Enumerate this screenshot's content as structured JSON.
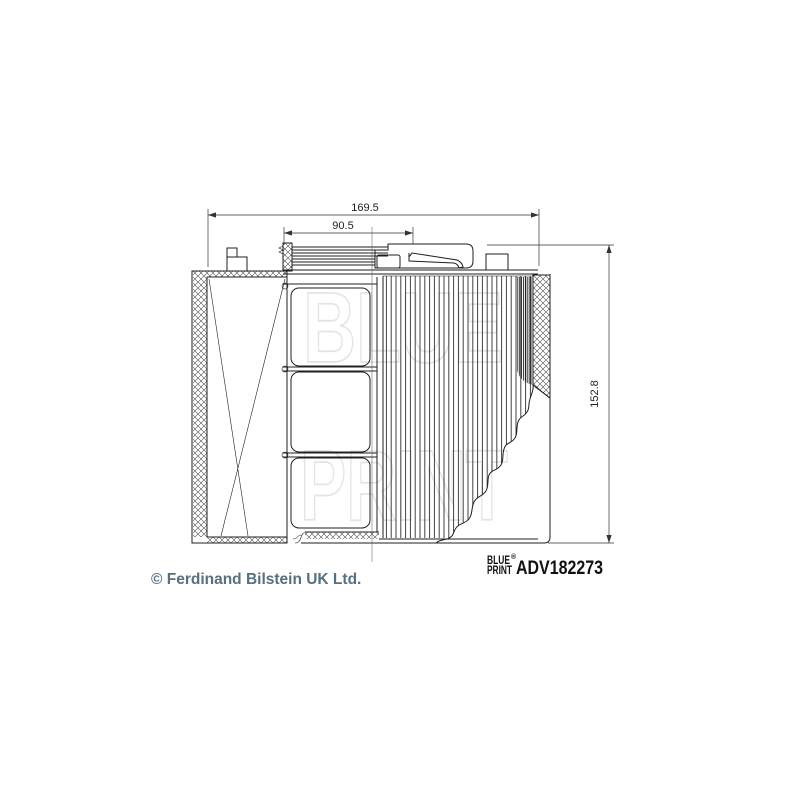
{
  "drawing": {
    "title": "air filter technical drawing",
    "line_color": "#1f1f1f",
    "dimensions": {
      "overall_width": "169.5",
      "cap_width": "90.5",
      "overall_height": "152.8"
    },
    "watermark": {
      "line1": "BLUE",
      "line2": "PRINT",
      "color": "#e2e5e7"
    }
  },
  "footer": {
    "copyright": "© Ferdinand Bilstein UK Ltd.",
    "copyright_color": "#56707e",
    "brand": {
      "line1": "BLUE",
      "line2": "PRINT",
      "registered": "®"
    },
    "part_number": "ADV182273",
    "part_number_color": "#111111"
  }
}
